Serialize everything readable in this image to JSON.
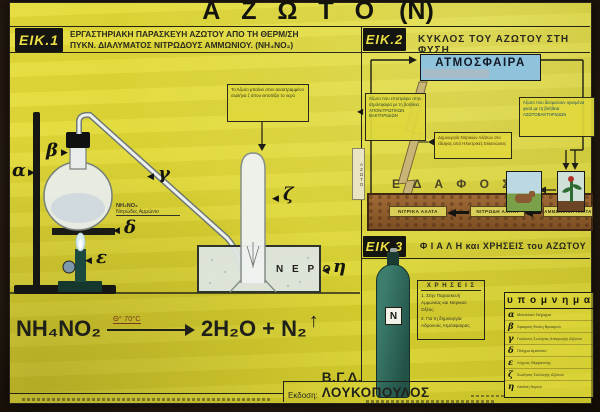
{
  "poster": {
    "title": "Α Ζ Ω Τ Ο",
    "title_symbol": "(Ν)",
    "edition_label": "Εκδοση:",
    "edition_name": "Β.Γ.Δ.  ΛΟΥΚΟΠΟΥΛΟΣ"
  },
  "fig1": {
    "tag": "ΕΙΚ.1",
    "title_line1": "ΕΡΓΑΣΤΗΡΙΑΚΗ  ΠΑΡΑΣΚΕΥΗ  ΑΖΩΤΟΥ  ΑΠΟ  ΤΗ  ΘΕΡΜ/ΣΗ",
    "title_line2": "ΠΥΚΝ.  ΔΙΑΛΥΜΑΤΟΣ  ΝΙΤΡΩΔΟΥΣ  ΑΜΜΩΝΙΟΥ.    (ΝΗ₄ΝΟ₂)",
    "labels": {
      "a": "α",
      "b": "β",
      "g": "γ",
      "d": "δ",
      "e": "ε",
      "z": "ζ",
      "h": "η"
    },
    "note_box": "Το Άζωτο μπαίνει στον αναστραμμένο σωλήνα ζ όπου εκτοπίζει το νερό",
    "flask_formula": "ΝΗ₄ΝΟ₂",
    "flask_name": "Νιτρώδες Αμμώνιο",
    "water_label": "Ν Ε Ρ Ο",
    "equation": {
      "reactant": "NH₄NO₂",
      "condition": "Θ° 70°C",
      "products": "2H₂O + N₂",
      "gas_arrow": "↑"
    }
  },
  "fig2": {
    "tag": "ΕΙΚ.2",
    "title": "ΚΥΚΛΟΣ  ΤΟΥ  ΑΖΩΤΟΥ  ΣΤΗ  ΦΥΣΗ",
    "atmosphere_label": "ΑΤΜΟΣΦΑΙΡΑ",
    "left_note": "Άζωτο που επιστρέφει στην ατμόσφαιρα με τη βοήθεια ΑΠΟΝΙΤΡΩΤΙΚΩΝ ΒΑΚΤΗΡΙΔΙΩΝ",
    "right_note": "Άζωτο που δεσμεύουν ορισμένα φυτά με τη βοήθεια ΑΖΩΤΟΒΑΚΤΗΡΙΔΙΩΝ",
    "middle_note": "Δημιουργία Νιτρικών Αλάτων στο έδαφος από Ηλεκτρικές Εκκενώσεις",
    "soil_label": "Ε Δ Α Φ Ο Σ",
    "side_label": "ΑΖΩΤΟ",
    "salts": [
      "ΝΙΤΡΙΚΑ ΑΛΑΤΑ",
      "ΝΙΤΡΩΔΗ ΑΛΑΤΑ",
      "ΑΜΜΩΝΙΑΚΑ ΑΛΑΤΑ"
    ]
  },
  "fig3": {
    "tag": "ΕΙΚ.3",
    "title": "Φ Ι Α Λ Η  και  ΧΡΗΣΕΙΣ  του  ΑΖΩΤΟΥ",
    "cylinder_letter": "N",
    "uses_title": "Χ Ρ Η Σ Ε Ι Σ",
    "uses": [
      "1. Στην Παρασκευή Αμμωνίας και Νιτρικού Οξέος.",
      "2. Για τη δημιουργία Αδρανούς Ατμόσφαιρας."
    ]
  },
  "legend": {
    "title": "υ π ο μ ν η μ α",
    "items": [
      {
        "letter": "α",
        "text": "Μεταλλικό Στήριγμα"
      },
      {
        "letter": "β",
        "text": "Σφαιρική Φιάλη Βρασμού"
      },
      {
        "letter": "γ",
        "text": "Γυάλινος Σωλήνας Απαγωγής Αζώτου"
      },
      {
        "letter": "δ",
        "text": "Πλέγμα Αμιάντου"
      },
      {
        "letter": "ε",
        "text": "Λύχνος Θέρμανσης"
      },
      {
        "letter": "ζ",
        "text": "Σωλήνας Συλλογής Αζώτου"
      },
      {
        "letter": "η",
        "text": "Λεκάνη Νερού"
      }
    ]
  },
  "colors": {
    "poster_yellow": "#dcd531",
    "atmosphere_blue": "#8fc2db",
    "soil_brown": "#96612f",
    "cylinder_teal": "#2e6f62",
    "frame_dark": "#241a10",
    "lightning_tan": "#c9b478"
  }
}
